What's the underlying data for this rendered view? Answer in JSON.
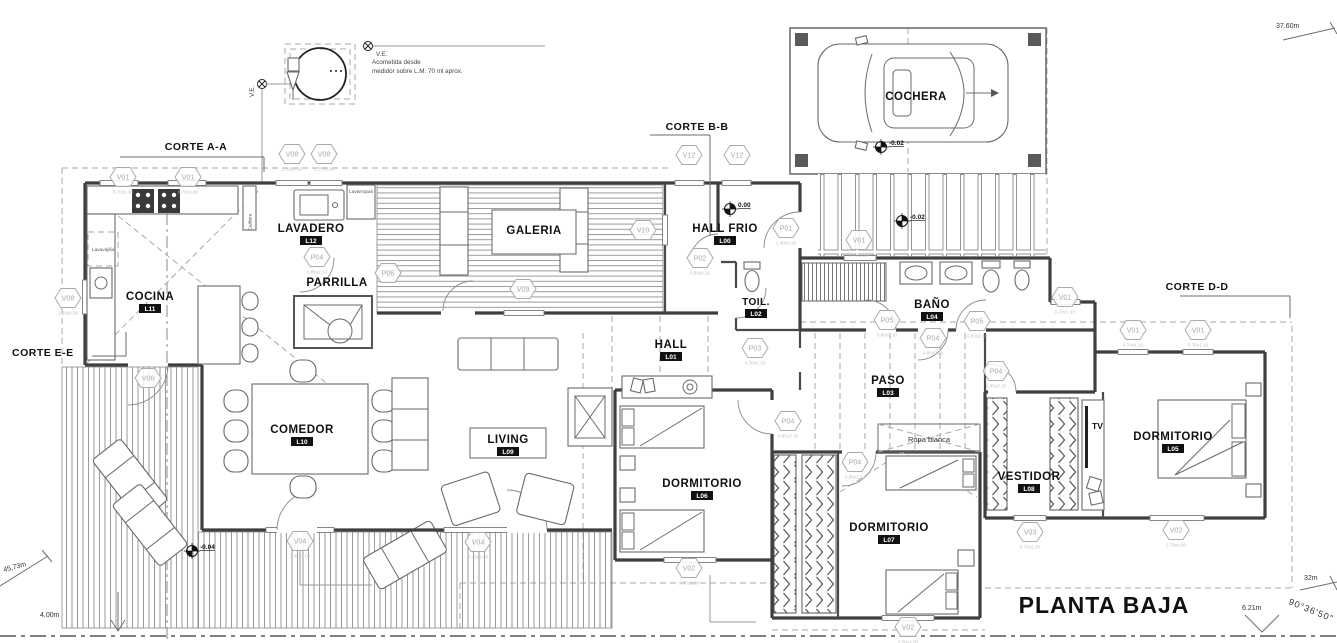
{
  "title": "PLANTA BAJA",
  "sections": {
    "aa": "CORTE A-A",
    "bb": "CORTE B-B",
    "dd": "CORTE D-D",
    "ee": "CORTE E-E"
  },
  "rooms": [
    {
      "name": "COCHERA",
      "code": ""
    },
    {
      "name": "LAVADERO",
      "code": "L12"
    },
    {
      "name": "COCINA",
      "code": "L11"
    },
    {
      "name": "PARRILLA",
      "code": ""
    },
    {
      "name": "GALERIA",
      "code": ""
    },
    {
      "name": "HALL FRIO",
      "code": "L00"
    },
    {
      "name": "TOIL.",
      "code": "L02"
    },
    {
      "name": "HALL",
      "code": "L01"
    },
    {
      "name": "BAÑO",
      "code": "L04"
    },
    {
      "name": "PASO",
      "code": "L03"
    },
    {
      "name": "COMEDOR",
      "code": "L10"
    },
    {
      "name": "LIVING",
      "code": "L09"
    },
    {
      "name": "DORMITORIO",
      "code": "L06"
    },
    {
      "name": "DORMITORIO",
      "code": "L07"
    },
    {
      "name": "DORMITORIO",
      "code": "L05"
    },
    {
      "name": "VESTIDOR",
      "code": "L08"
    }
  ],
  "equipment": {
    "caldera": "Caldera",
    "lavarropas": "Lavarropas",
    "lavavajilla": "Lavavajilla",
    "ropa_blanca": "Ropa blanca",
    "tv": "TV"
  },
  "notes": {
    "acometida_line1": "Acometida desde",
    "acometida_line2": "medidor sobre L.M. 70 ml aprox.",
    "valve_left": "V.E.",
    "valve_right": "V.E."
  },
  "dimensions": {
    "top_right": "37.60m",
    "left": "45,73m",
    "bottom_left": "4,00m",
    "right": "32m",
    "bottom_right": "6.21m",
    "angle": "90°36'50\""
  },
  "levels": [
    {
      "label": "-0.02",
      "x": 881,
      "y": 147
    },
    {
      "label": "-0.02",
      "x": 902,
      "y": 221
    },
    {
      "label": "0.00",
      "x": 730,
      "y": 209
    },
    {
      "label": "-0.04",
      "x": 192,
      "y": 551
    }
  ],
  "markers": [
    {
      "label": "V01",
      "dim": "0.70x1.00",
      "x": 123,
      "y": 177
    },
    {
      "label": "V01",
      "dim": "0.70x1.00",
      "x": 188,
      "y": 177
    },
    {
      "label": "V08",
      "dim": "2.35x1.00",
      "x": 292,
      "y": 154
    },
    {
      "label": "V08",
      "dim": "2.35x1.00",
      "x": 324,
      "y": 154
    },
    {
      "label": "V08",
      "dim": "2.35x1.00",
      "x": 68,
      "y": 298
    },
    {
      "label": "V06",
      "dim": "",
      "x": 148,
      "y": 378
    },
    {
      "label": "V09",
      "dim": "",
      "x": 523,
      "y": 289
    },
    {
      "label": "V10",
      "dim": "",
      "x": 643,
      "y": 230
    },
    {
      "label": "V12",
      "dim": "",
      "x": 689,
      "y": 155
    },
    {
      "label": "V12",
      "dim": "",
      "x": 737,
      "y": 155
    },
    {
      "label": "P01",
      "dim": "1.40x2.20",
      "x": 786,
      "y": 228
    },
    {
      "label": "P02",
      "dim": "0.90x2.10",
      "x": 700,
      "y": 258
    },
    {
      "label": "P03",
      "dim": "0.70x2.10",
      "x": 755,
      "y": 348
    },
    {
      "label": "P04",
      "dim": "0.85x2.10",
      "x": 317,
      "y": 257
    },
    {
      "label": "P06",
      "dim": "",
      "x": 388,
      "y": 273
    },
    {
      "label": "P05",
      "dim": "0.80x2.10",
      "x": 887,
      "y": 320
    },
    {
      "label": "P05",
      "dim": "0.80x2.10",
      "x": 977,
      "y": 321
    },
    {
      "label": "P04",
      "dim": "0.85x2.10",
      "x": 933,
      "y": 338
    },
    {
      "label": "P04",
      "dim": "0.85x2.10",
      "x": 996,
      "y": 371
    },
    {
      "label": "P04",
      "dim": "0.85x2.10",
      "x": 788,
      "y": 421
    },
    {
      "label": "P04",
      "dim": "0.85x2.10",
      "x": 855,
      "y": 462
    },
    {
      "label": "V01",
      "dim": "0.70x1.10",
      "x": 859,
      "y": 240
    },
    {
      "label": "V01",
      "dim": "0.70x1.10",
      "x": 1065,
      "y": 297
    },
    {
      "label": "V01",
      "dim": "0.70x1.10",
      "x": 1133,
      "y": 330
    },
    {
      "label": "V01",
      "dim": "0.70x1.10",
      "x": 1198,
      "y": 330
    },
    {
      "label": "V02",
      "dim": "2.70x1.50",
      "x": 689,
      "y": 568
    },
    {
      "label": "V02",
      "dim": "2.70x1.50",
      "x": 908,
      "y": 627
    },
    {
      "label": "V02",
      "dim": "2.70x1.50",
      "x": 1176,
      "y": 530
    },
    {
      "label": "V03",
      "dim": "0.70x1.20",
      "x": 1030,
      "y": 532
    },
    {
      "label": "V04",
      "dim": "3.45x2.05",
      "x": 300,
      "y": 541
    },
    {
      "label": "V04",
      "dim": "3.45x2.05",
      "x": 478,
      "y": 542
    }
  ],
  "colors": {
    "wall": "#3f3f3f",
    "hatch": "#9a9a9a",
    "marker": "#a8a8a8",
    "text": "#111111"
  }
}
